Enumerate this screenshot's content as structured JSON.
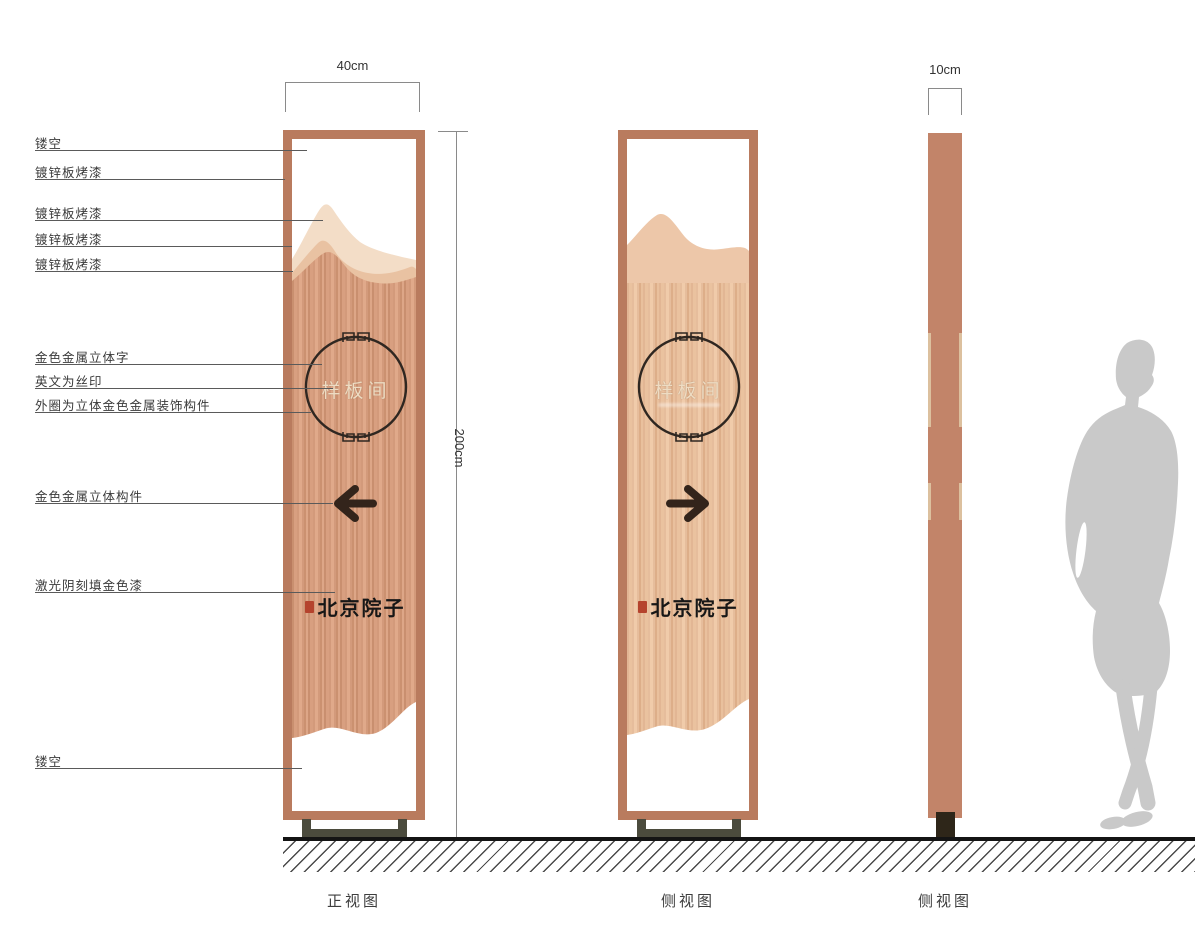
{
  "annotations": [
    {
      "label": "镂空"
    },
    {
      "label": "镀锌板烤漆"
    },
    {
      "label": "镀锌板烤漆"
    },
    {
      "label": "镀锌板烤漆"
    },
    {
      "label": "镀锌板烤漆"
    },
    {
      "label": "金色金属立体字"
    },
    {
      "label": "英文为丝印"
    },
    {
      "label": "外圈为立体金色金属装饰构件"
    },
    {
      "label": "金色金属立体构件"
    },
    {
      "label": "激光阴刻填金色漆"
    },
    {
      "label": "镂空"
    }
  ],
  "dimensions": {
    "front_width": "40cm",
    "height": "200cm",
    "side_width": "10cm"
  },
  "sign": {
    "room_label": "样板间",
    "brand": "北京院子",
    "front_arrow": "left-arrow",
    "side_arrow": "right-arrow"
  },
  "views": [
    {
      "label": "正视图"
    },
    {
      "label": "侧视图"
    },
    {
      "label": "侧视图"
    }
  ],
  "colors": {
    "frame_copper": "#b97b5e",
    "body_copper": "#d39a7b",
    "body_copper_light": "#e6bd9c",
    "mountain_light": "#f3ddc7",
    "mountain_mid": "#e9c2a2",
    "circle_stroke": "#2f2721",
    "room_text": "#eedcc3",
    "arrow": "#33241b",
    "seal_red": "#b5432d",
    "base_olive": "#4b4b3d",
    "silhouette_gray": "#c9c9c9"
  }
}
